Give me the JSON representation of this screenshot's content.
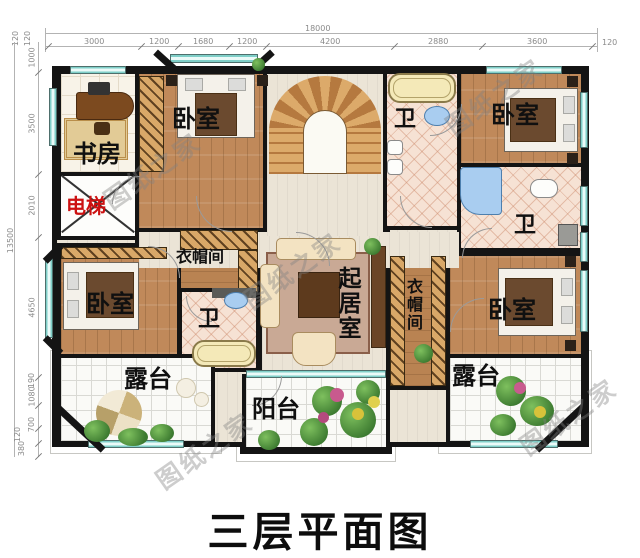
{
  "title": "三层平面图",
  "watermark": "图纸之家",
  "dimensions": {
    "top": {
      "total": "18000",
      "segments": [
        "120",
        "3000",
        "1200",
        "1680",
        "1200",
        "4200",
        "2880",
        "3600",
        "120"
      ]
    },
    "left": {
      "total": "13500",
      "segments": [
        "120",
        "1000",
        "3500",
        "2010",
        "4650",
        "190",
        "1080",
        "700",
        "120",
        "380"
      ]
    }
  },
  "rooms": {
    "study": "书房",
    "elevator": "电梯",
    "bedroom_top_left": "卧室",
    "bedroom_top_right": "卧室",
    "bedroom_bottom_left": "卧室",
    "bedroom_bottom_right": "卧室",
    "bath_top_right": "卫",
    "bath_mid_right": "卫",
    "bath_bottom_left": "卫",
    "cloakroom_left": "衣帽间",
    "cloakroom_right": "衣帽间",
    "living_room": "起居室",
    "terrace_left": "露台",
    "terrace_right": "露台",
    "balcony": "阳台"
  },
  "colors": {
    "wall": "#141414",
    "wood_floor": "#c0895a",
    "window": "#7fcfc8",
    "elevator_text": "#cc1111",
    "dimension_text": "#8a8a8a",
    "title_text": "#111111"
  }
}
